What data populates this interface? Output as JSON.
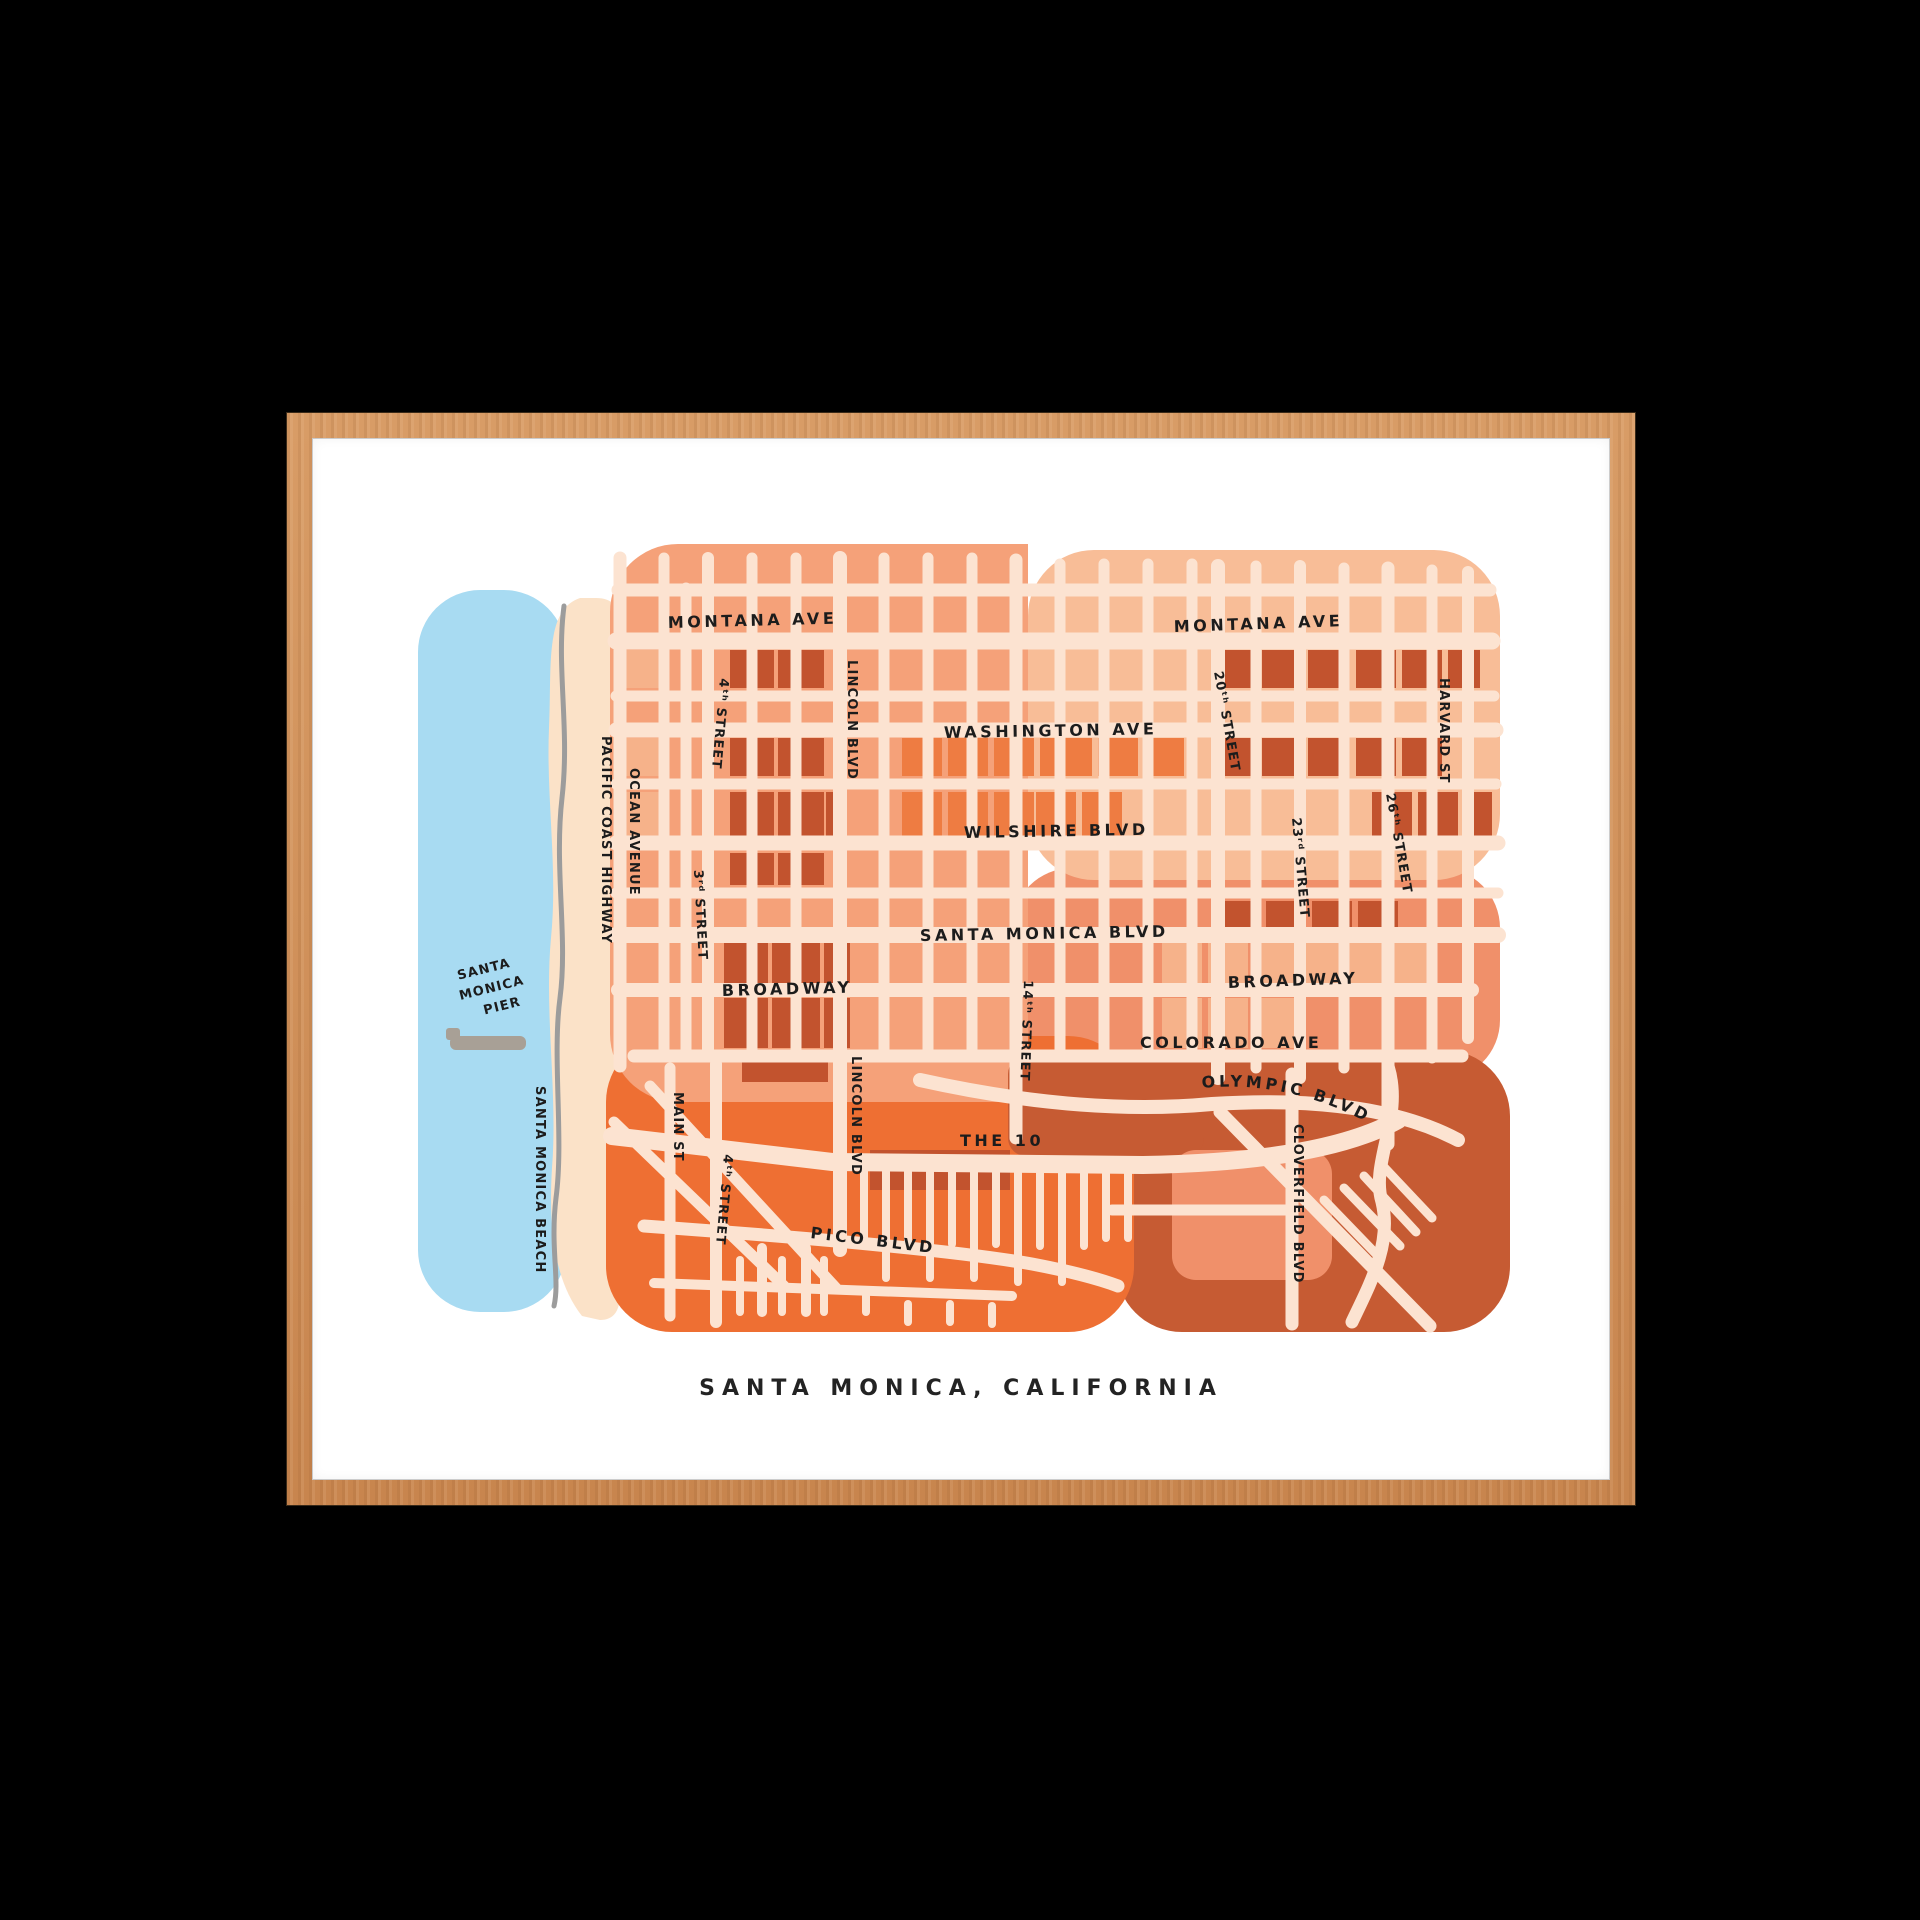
{
  "caption": "SANTA MONICA, CALIFORNIA",
  "labels": {
    "montana_ave_w": "MONTANA AVE",
    "montana_ave_e": "MONTANA AVE",
    "washington_ave": "WASHINGTON AVE",
    "wilshire_blvd": "WILSHIRE BLVD",
    "santa_monica_blvd": "SANTA MONICA BLVD",
    "broadway_w": "BROADWAY",
    "broadway_e": "BROADWAY",
    "colorado_ave": "COLORADO AVE",
    "olympic_blvd": "OLYMPIC BLVD",
    "the_10": "THE 10",
    "pico_blvd": "PICO BLVD",
    "ocean_avenue": "OCEAN AVENUE",
    "pacific_coast_highway": "PACIFIC COAST HIGHWAY",
    "main_st": "MAIN ST",
    "street_3rd": "3ʳᵈ STREET",
    "street_4th_n": "4ᵗʰ STREET",
    "street_4th_s": "4ᵗʰ STREET",
    "lincoln_blvd_n": "LINCOLN BLVD",
    "lincoln_blvd_s": "LINCOLN BLVD",
    "street_14th": "14ᵗʰ STREET",
    "street_20th": "20ᵗʰ STREET",
    "street_23rd": "23ʳᵈ STREET",
    "street_26th": "26ᵗʰ STREET",
    "harvard_st": "HARVARD ST",
    "cloverfield_blvd": "CLOVERFIELD BLVD",
    "pier_line1": "SANTA",
    "pier_line2": "MONICA",
    "pier_line3": "PIER",
    "santa_monica_beach": "SANTA MONICA BEACH"
  },
  "colors": {
    "background": "#000000",
    "frame_wood": "#CD8F58",
    "print": "#FFFFFF",
    "ink": "#1C1C1C",
    "ocean_blue": "#A8DBF2",
    "beach_sand": "#FBE2C8",
    "street_cream": "#FCE3D1",
    "district_salmon": "#F5A179",
    "district_peach": "#F8BD97",
    "district_coral": "#F0906A",
    "district_orange": "#EE6F33",
    "district_rust": "#C65B33",
    "block_dark": "#C2532E",
    "block_orange": "#EE7C42",
    "block_light": "#F6B28A",
    "bike_path_gray": "#9C9C9C",
    "pier_gray": "#A8A096"
  }
}
